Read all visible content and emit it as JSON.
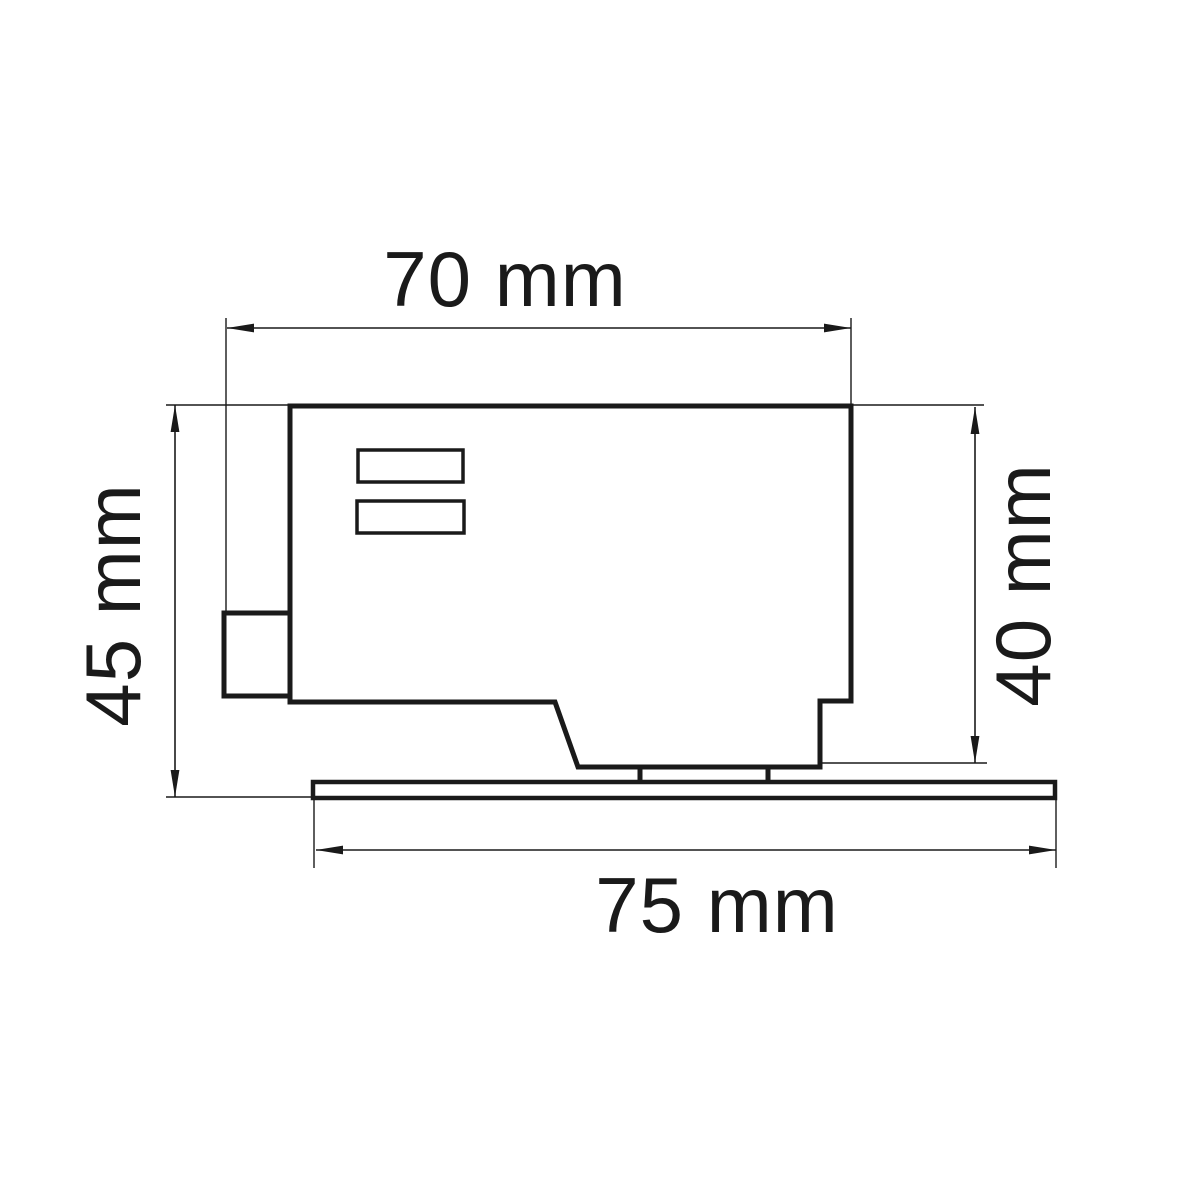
{
  "page": {
    "background_color": "#ffffff",
    "line_color": "#1a1a1a"
  },
  "drawing": {
    "kind": "technical-dimension-diagram",
    "subject": "track-adapter-side-view",
    "labels": {
      "top_width": "70 mm",
      "left_height": "45 mm",
      "right_height": "40 mm",
      "bottom_width": "75 mm"
    }
  }
}
